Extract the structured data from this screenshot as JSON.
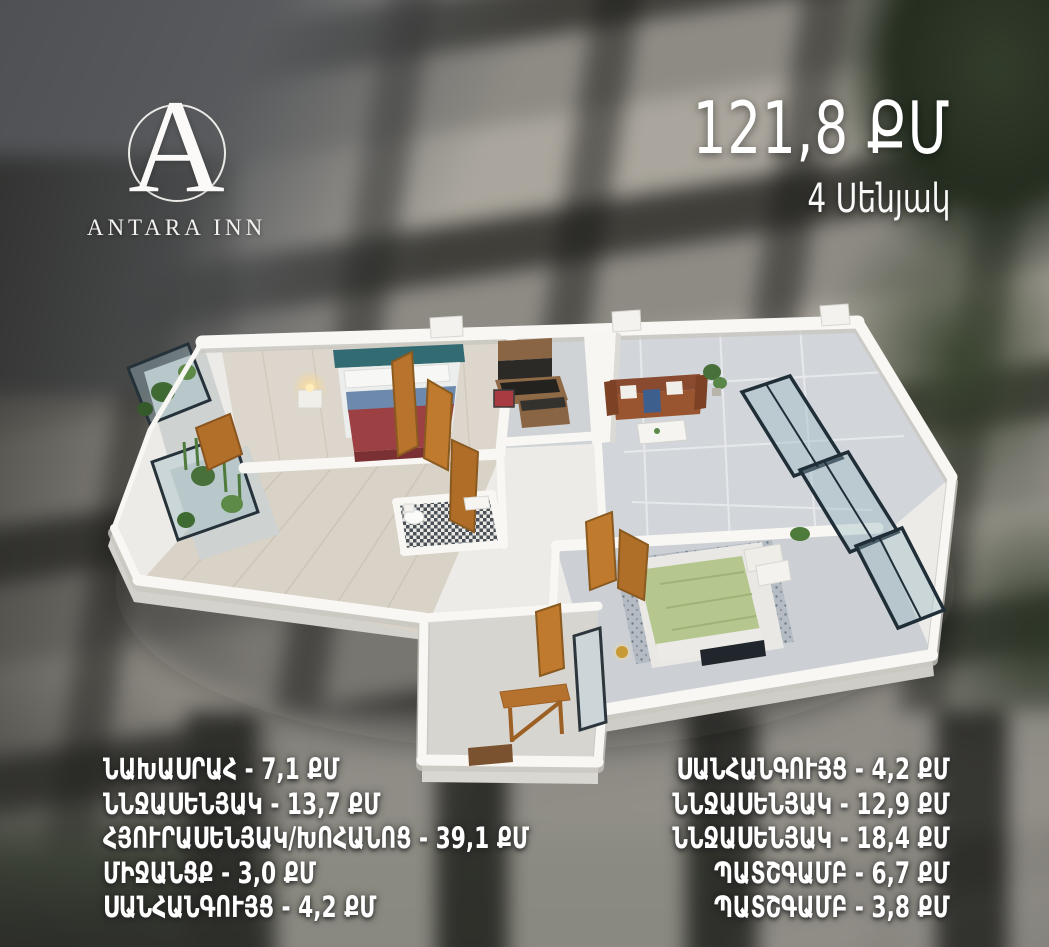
{
  "brand": {
    "initial": "A",
    "name": "ANTARA INN"
  },
  "summary": {
    "area": "121,8 ՔՄ",
    "rooms": "4 Սենյակ"
  },
  "rooms_left": [
    "ՆԱԽԱՍՐԱՀ - 7,1 ՔՄ",
    "ՆՆՋԱՍԵՆՅԱԿ - 13,7 ՔՄ",
    "ՀՅՈՒՐԱՍԵՆՅԱԿ/ԽՈՀԱՆՈՑ - 39,1 ՔՄ",
    "ՄԻՋԱՆՑՔ - 3,0 ՔՄ",
    "ՍԱՆՀԱՆԳՈՒՅՑ - 4,2 ՔՄ"
  ],
  "rooms_right": [
    "ՍԱՆՀԱՆԳՈՒՅՑ - 4,2 ՔՄ",
    "ՆՆՋԱՍԵՆՅԱԿ - 12,9 ՔՄ",
    "ՆՆՋԱՍԵՆՅԱԿ - 18,4 ՔՄ",
    "ՊԱՏՇԳԱՄԲ - 6,7 ՔՄ",
    "ՊԱՏՇԳԱՄԲ - 3,8 ՔՄ"
  ],
  "colors": {
    "text": "#ffffff",
    "wall_white": "#f8f7f3",
    "floor_tile": "#d2d6da",
    "wood_floor": "#dcd6cc",
    "door_wood": "#bf7a2e",
    "bed_red": "#9c4044",
    "bed_green": "#b5c78f",
    "sofa_brown": "#8a4a30",
    "headboard_teal": "#336b72",
    "foliage_green": "#333d2c"
  }
}
